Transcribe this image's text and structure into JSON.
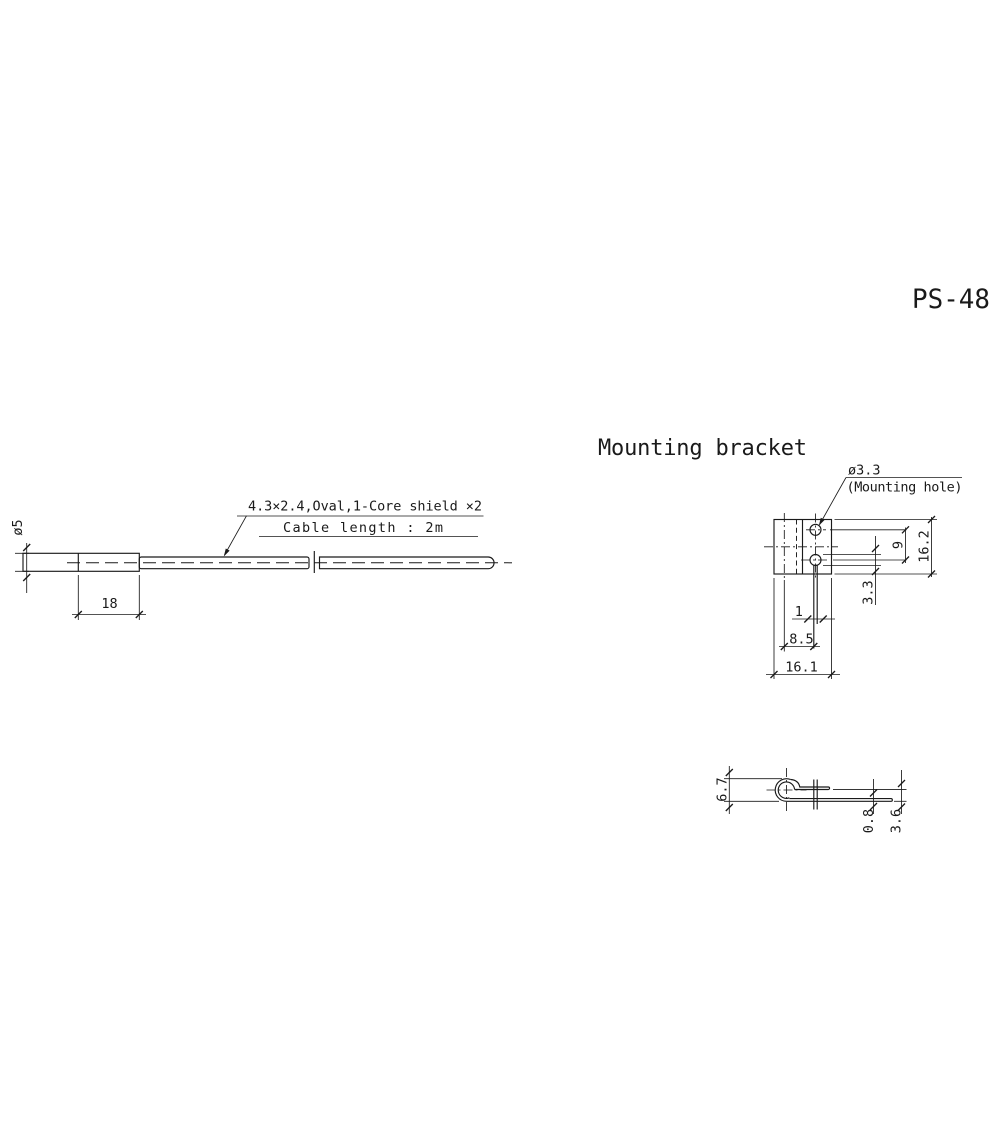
{
  "page": {
    "model_number": "PS-48",
    "background_color": "#ffffff",
    "line_color": "#1a1a1a"
  },
  "sensor_view": {
    "cable_note_line1": "4.3×2.4,Oval,1-Core shield ×2",
    "cable_note_line2": "Cable length : 2m",
    "dims": {
      "body_length": "18",
      "body_diameter": "ø5"
    }
  },
  "mounting_bracket": {
    "heading": "Mounting bracket",
    "hole_callout": {
      "diameter": "ø3.3",
      "label": "(Mounting hole)"
    },
    "top_view_dims": {
      "overall_depth": "16.2",
      "hole_pitch": "9",
      "hole_diameter": "3.3",
      "slot_width": "1",
      "slot_offset": "8.5",
      "overall_width": "16.1"
    },
    "side_view_dims": {
      "overall_height": "6.7",
      "material_thickness": "0.8",
      "opening": "3.6"
    }
  }
}
